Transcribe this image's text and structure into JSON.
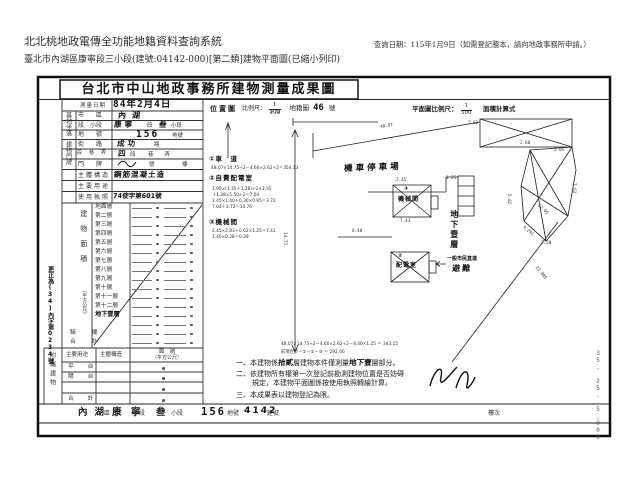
{
  "page_header": {
    "system_name": "北北桃地政電傳全功能地籍資料查詢系統",
    "query_date_note": "查詢日期：115年1月9日（如需登記謄本，請向地政事務所申請。）",
    "document_caption": "臺北市內湖區康寧段三小段(建號:04142-000)[第二類]建物平面圖(已縮小列印)"
  },
  "doc": {
    "title": "台北市中山地政事務所建物測量成果圖",
    "survey_date": {
      "label": "測量日期",
      "value": "84年2月4日"
    },
    "site": {
      "group": "基地坐落",
      "city": {
        "label": "市　　區",
        "value": "內湖"
      },
      "section": {
        "label": "段　小段",
        "v1": "康寧",
        "m1": "段",
        "v2": "叁",
        "s1": "小段"
      },
      "land_no": {
        "label": "地　　號",
        "value": "156",
        "suffix": "地號"
      }
    },
    "address": {
      "group": "建物門牌",
      "street": {
        "label": "街　　路",
        "value": "成功",
        "suffix": "路"
      },
      "lane": {
        "label": "段　巷　弄",
        "v1": "四",
        "m1": "段",
        "s1": "巷　　弄"
      },
      "door": {
        "label": "門　　牌",
        "m1": "號",
        "s1": "樓"
      }
    },
    "structure": {
      "label": "主體構造",
      "value": "鋼筋混凝土造"
    },
    "main_use": {
      "label": "主要用途",
      "value": ""
    },
    "license": {
      "label": "使用執照",
      "value": "74使字第601號"
    },
    "area": {
      "group": "建物面積",
      "unit": "（平方公尺）",
      "floors": [
        "地面層",
        "第二層",
        "第三層",
        "第四層",
        "第五層",
        "第六層",
        "第七層",
        "第八層",
        "第九層",
        "第十層",
        "第十一層",
        "第十二層",
        "地下壹層",
        "",
        "騎　樓",
        "合　計"
      ]
    },
    "annex": {
      "group": "附屬建物",
      "col_use": "主要用途",
      "col_structure": "主體構造",
      "col_area1": "面　積",
      "col_area2": "（平方公尺）",
      "rows": [
        "平　台",
        "陽　台",
        ""
      ],
      "total": "合　計"
    },
    "margin_note": "更正為(34)內字第0234號",
    "scales": {
      "location_label": "位置圖",
      "location_scale_label": "比例尺：",
      "location_num": "1",
      "location_den": "500",
      "map_sheet_label": "地籍圖",
      "map_sheet_no": "46",
      "map_sheet_suffix": "號",
      "plan_scale_label": "平面圖比例尺：",
      "plan_num": "1",
      "plan_den": "500",
      "plan_suffix": "面積計算式"
    },
    "plan": {
      "parking": "機車停車場",
      "box1_no": "③",
      "box1": "機械間",
      "box2_no": "②",
      "box2": "配電室",
      "basement": "地下壹層",
      "shelter_line1": "一般市民直達",
      "shelter_line2": "避難",
      "annotations": [
        {
          "t": "①車　道"
        },
        {
          "t": "48.07×14.75÷2－4.60×2.62÷2＝354.13"
        },
        {
          "t": "②自費配電室"
        },
        {
          "t": "1.90×(1.35＋1.28)÷2×3.35"
        },
        {
          "t": "＋1.28×1.50÷2＝7.04"
        },
        {
          "t": "2.45×1.40＋0.30×0.95＝3.72"
        },
        {
          "t": "7.04＋3.72＝10.76"
        },
        {
          "t": "③機械間"
        },
        {
          "t": "2.45×2.83＋0.62×1.25＝7.43"
        },
        {
          "t": "1.40×0.28＝0.39"
        }
      ],
      "calc1": "48.07×14.75÷2－4.60×2.62÷2－8.40×1.25 ＝ 343.15",
      "calc2": "前項合計－①－②－③ ＝ 292.66",
      "dims": [
        "4.60",
        "48.07",
        "2.62",
        "2.60",
        "2.05",
        "7.62",
        "5.82",
        "12.05",
        "3.20",
        "9.291",
        "8.40",
        "2.45",
        "7.43",
        "1.25",
        "23.095",
        "14.75"
      ]
    },
    "notes": {
      "n1a": "一、本建物係",
      "n1b": "拾貳",
      "n1c": "層建物本件僅測量",
      "n1d": "地下壹",
      "n1e": "層部分。",
      "n2a": "二、依建物所有權第一次登記前勘測建物位置是否妨碍",
      "n2b": "規定，本建物平面圖係按使用執照轉繪計算。",
      "n3": "三、本成果表以建物登記為限。"
    },
    "footer": {
      "district": "內湖",
      "district_label": "區",
      "section": "康　寧",
      "section_label": "段",
      "subsection": "叁",
      "subsection_label": "小段",
      "land_no": "156",
      "land_no_label": "地號",
      "building_no": "4142",
      "building_no_label": "建號",
      "floor_label": "樓次"
    },
    "side_code": "35. 25. 5,000"
  }
}
